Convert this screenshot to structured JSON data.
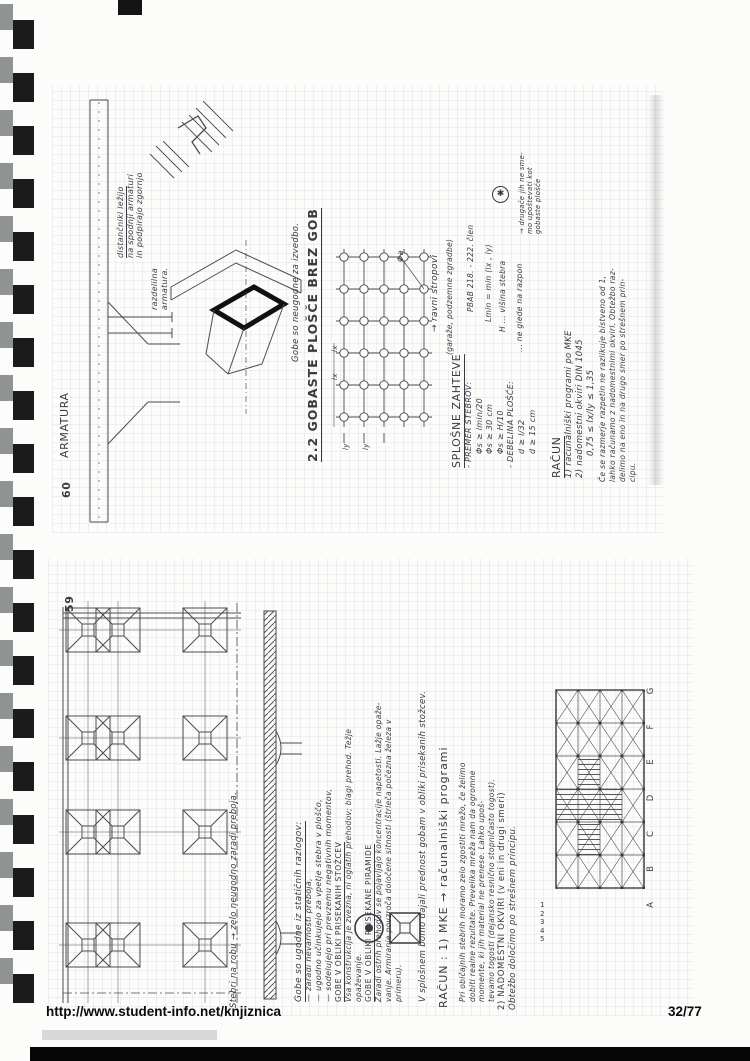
{
  "colors": {
    "ink": "#3a3a40",
    "paper": "#fcfcfa",
    "binding_black": "#1b1b1b",
    "binding_gray": "#909394"
  },
  "icons": {
    "truncated_cone_plan": "double-circle",
    "truncated_pyramid_plan": "square-with-x"
  },
  "footer": {
    "url": "http://www.student-info.net/knjiznica",
    "pages": "32/77"
  },
  "page60": {
    "number": "60",
    "armatura": "ARMATURA",
    "spacers": {
      "l1": "distančniki ležijo",
      "l2": "na spodnji armaturi",
      "l3": "in podpirajo zgornjo"
    },
    "razdelilna": {
      "l1": "razdelilna",
      "l2": "armatura."
    },
    "gobe_note": "Gobe so neugodne za izvedbo.",
    "heading": "2.2  GOBASTE  PLOŠČE  BREZ  GOB",
    "grid": {
      "phi": "Φa",
      "lx": "lx",
      "ly": "ly"
    },
    "ravni": "→ ravni stropovi",
    "garaze": "(garaže, podzemne zgradbe)",
    "pbab": "PBAB  218. - 222. člen",
    "lmin": "Lmin = min (lx , ly)",
    "visina": "H ... višina stebra",
    "neglede": "... ne glede na razpon",
    "asterisk": "✱",
    "drugace": {
      "l1": "→ drugače jih ne sme-",
      "l2": "mo upoštevati kot",
      "l3": "gobaste plošče"
    },
    "splosne": {
      "title": "SPLOŠNE ZAHTEVE",
      "premer": "- PREMER STEBROV:",
      "p1": "Φs ≥ lmin/20",
      "p2": "Φs ≥ 30 cm",
      "p3": "Φs ≥ H/10",
      "debelina": "- DEBELINA PLOŠČE:",
      "d1": "d ≥ l/32",
      "d2": "d ≥ 15 cm"
    },
    "racun": {
      "title": "RAČUN",
      "i1": "1) računalniški programi  po MKE",
      "i2": "2) nadomestni okviri    DIN 1045",
      "i3": "0,75 ≤ lx/ly ≤ 1,35",
      "p1": "Če se razmerje razpetin ne razlikuje bistveno od 1,",
      "p2": "lahko računamo z nadomestnimi okviri. Obtežbo raz-",
      "p3": "delimo na eno in na drugo smer po strešnem prin-",
      "p4": "cipu."
    }
  },
  "page59": {
    "number": "59",
    "edge_label": "Stebri na robu → zelo neugodno zaradi preboja.",
    "gobe": {
      "title": "Gobe so ugodne iz statičnih razlogov:",
      "b1": "— zaradi nevarnosti preboja,",
      "b2": "— ugodno učinkujejo za vpetje stebra v ploščo,",
      "b3": "— sodelujejo pri prevzemu negativnih momentov,",
      "stozci_h": "GOBE V OBLIKI PRISEKANIH STOŽCEV",
      "stozci_1": "Vsa konstrukcija je zvezna, ni oglatih prehodov; blagi prehod. Težje",
      "stozci_2": "opaževanje.",
      "piramide_h": "GOBE V OBLIKI PRISEKANE PIRAMIDE",
      "piramide_1": "Zaradi ostrih prehodov se pojavljajo koncentracije napetosti. Lažje opaže-",
      "piramide_2": "vanje. Armiranje povzroča določene sitnosti (štrleča počezna železa v",
      "piramide_3": "primeru)."
    },
    "splosnem": "V splošnem bomo dajali prednost gobam v obliki prisekanih stožcev.",
    "racun": {
      "title": "RAČUN :   1) MKE  →  računalniški programi",
      "p1": "Pri običajnih stebrih moramo zelo zgostiti mrežo, če želimo",
      "p2": "dobiti realne rezultate. Prevelika mreža nam da ogromne",
      "p3": "momente, ki jih material ne prenese. Lahko upoš-",
      "p4": "tevamo togosti (dejansko resnično stopničasto togost).",
      "n1": "2) NADOMESTNI OKVIRI   (v eni in drugi smeri)",
      "n2": "Obtežbo določimo po strešnem principu."
    },
    "axis": {
      "letters": [
        "A",
        "B",
        "C",
        "D",
        "E",
        "F",
        "G"
      ],
      "numbers": [
        "1",
        "2",
        "3",
        "4",
        "5"
      ]
    }
  }
}
